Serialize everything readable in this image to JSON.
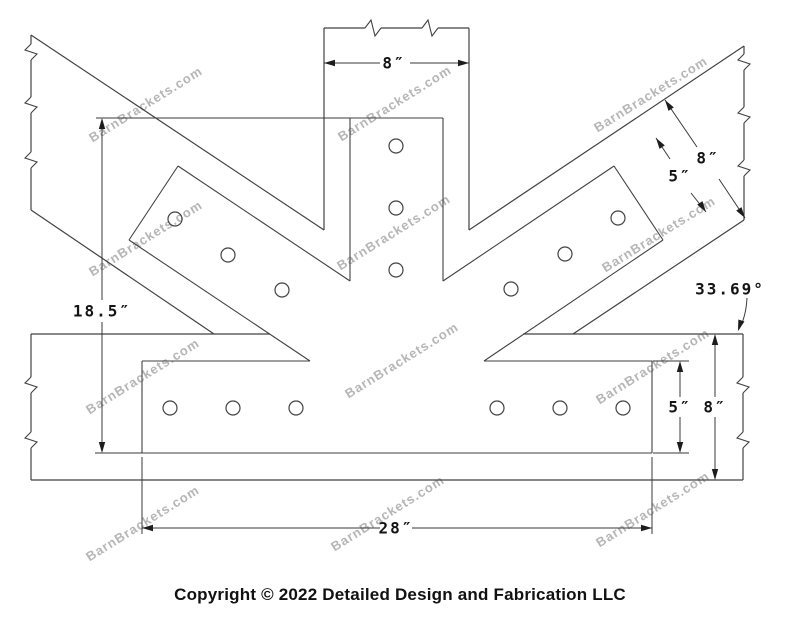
{
  "copyright": "Copyright © 2022 Detailed Design and Fabrication LLC",
  "watermark_text": "BarnBrackets.com",
  "canvas": {
    "width": 800,
    "height": 618,
    "background": "#ffffff"
  },
  "colors": {
    "geometry_line": "#424242",
    "dimension_line": "#3a3a3a",
    "dimension_text": "#141414",
    "watermark": "#b7b5b5"
  },
  "drawing": {
    "description": "Fan bracket shop drawing: vertical post, two 33.69-degree braces, horizontal beam, steel fan plate with bolt holes",
    "timber_segments": [
      [
        324,
        28,
        324,
        230
      ],
      [
        469,
        28,
        469,
        230
      ],
      [
        324,
        28,
        365,
        28
      ],
      [
        381,
        28,
        422,
        28
      ],
      [
        438,
        28,
        469,
        28
      ],
      [
        31,
        35,
        324,
        230
      ],
      [
        31,
        210,
        214,
        334
      ],
      [
        31,
        35,
        31,
        44
      ],
      [
        31,
        60,
        31,
        97
      ],
      [
        31,
        113,
        31,
        152
      ],
      [
        31,
        168,
        31,
        210
      ],
      [
        469,
        230,
        744,
        46
      ],
      [
        573,
        334,
        744,
        220
      ],
      [
        744,
        46,
        744,
        54
      ],
      [
        744,
        70,
        744,
        107
      ],
      [
        744,
        123,
        744,
        160
      ],
      [
        744,
        176,
        744,
        220
      ],
      [
        31,
        334,
        270,
        334
      ],
      [
        523,
        334,
        743,
        334
      ],
      [
        31,
        480,
        743,
        480
      ],
      [
        31,
        334,
        31,
        377
      ],
      [
        31,
        393,
        31,
        432
      ],
      [
        31,
        448,
        31,
        480
      ],
      [
        743,
        334,
        743,
        377
      ],
      [
        743,
        393,
        743,
        432
      ],
      [
        743,
        448,
        743,
        480
      ]
    ],
    "plate_segments": [
      [
        350,
        118,
        443,
        118
      ],
      [
        350,
        118,
        350,
        281
      ],
      [
        443,
        118,
        443,
        281
      ],
      [
        178,
        166,
        350,
        281
      ],
      [
        178,
        166,
        129,
        240
      ],
      [
        129,
        240,
        310,
        361
      ],
      [
        614,
        166,
        443,
        281
      ],
      [
        614,
        166,
        663,
        240
      ],
      [
        663,
        240,
        484,
        361
      ],
      [
        142,
        361,
        310,
        361
      ],
      [
        484,
        361,
        652,
        361
      ],
      [
        142,
        361,
        142,
        453
      ],
      [
        652,
        361,
        652,
        453
      ],
      [
        142,
        453,
        652,
        453
      ]
    ],
    "break_marks": [
      {
        "x": 373,
        "y": 28,
        "dir": "h"
      },
      {
        "x": 430,
        "y": 28,
        "dir": "h"
      },
      {
        "x": 31,
        "y": 52,
        "dir": "v"
      },
      {
        "x": 31,
        "y": 105,
        "dir": "v"
      },
      {
        "x": 31,
        "y": 160,
        "dir": "v"
      },
      {
        "x": 744,
        "y": 62,
        "dir": "v"
      },
      {
        "x": 744,
        "y": 115,
        "dir": "v"
      },
      {
        "x": 744,
        "y": 168,
        "dir": "v"
      },
      {
        "x": 31,
        "y": 385,
        "dir": "v"
      },
      {
        "x": 31,
        "y": 440,
        "dir": "v"
      },
      {
        "x": 743,
        "y": 385,
        "dir": "v"
      },
      {
        "x": 743,
        "y": 440,
        "dir": "v"
      }
    ],
    "hole_radius": 7,
    "holes": [
      [
        396,
        146
      ],
      [
        396,
        208
      ],
      [
        396,
        270
      ],
      [
        175,
        219
      ],
      [
        228,
        255
      ],
      [
        282,
        290
      ],
      [
        618,
        218
      ],
      [
        565,
        254
      ],
      [
        511,
        289
      ],
      [
        170,
        408
      ],
      [
        233,
        408
      ],
      [
        296,
        408
      ],
      [
        497,
        408
      ],
      [
        560,
        408
      ],
      [
        623,
        408
      ]
    ],
    "dimensions": [
      {
        "label": "8″",
        "label_x": 394,
        "label_y": 63,
        "segments": [
          [
            324,
            63,
            380,
            63
          ],
          [
            410,
            63,
            469,
            63
          ]
        ],
        "arrows": [
          [
            324,
            63,
            180
          ],
          [
            469,
            63,
            0
          ]
        ],
        "ext": []
      },
      {
        "label": "18.5″",
        "label_x": 102,
        "label_y": 311,
        "segments": [
          [
            102,
            122,
            102,
            300
          ],
          [
            102,
            322,
            102,
            449
          ]
        ],
        "arrows": [
          [
            102,
            118,
            270
          ],
          [
            102,
            453,
            90
          ]
        ],
        "ext": [
          [
            96,
            118,
            350,
            118
          ],
          [
            95,
            453,
            142,
            453
          ]
        ]
      },
      {
        "label": "8″",
        "label_x": 708,
        "label_y": 158,
        "segments": [
          [
            665,
            100,
            697,
            147
          ],
          [
            719,
            179,
            745,
            218
          ]
        ],
        "arrows": [
          [
            665,
            100,
            236
          ],
          [
            745,
            218,
            56
          ]
        ],
        "ext": []
      },
      {
        "label": "5″",
        "label_x": 680,
        "label_y": 176,
        "segments": [
          [
            656,
            138,
            670,
            159
          ],
          [
            691,
            193,
            706,
            212
          ]
        ],
        "arrows": [
          [
            656,
            138,
            236
          ],
          [
            706,
            212,
            56
          ]
        ],
        "ext": []
      },
      {
        "label": "5″",
        "label_x": 680,
        "label_y": 407,
        "segments": [
          [
            680,
            365,
            680,
            397
          ],
          [
            680,
            417,
            680,
            449
          ]
        ],
        "arrows": [
          [
            680,
            361,
            270
          ],
          [
            680,
            453,
            90
          ]
        ],
        "ext": [
          [
            653,
            361,
            689,
            361
          ],
          [
            653,
            453,
            689,
            453
          ]
        ]
      },
      {
        "label": "8″",
        "label_x": 715,
        "label_y": 407,
        "segments": [
          [
            715,
            338,
            715,
            397
          ],
          [
            715,
            417,
            715,
            476
          ]
        ],
        "arrows": [
          [
            715,
            334,
            270
          ],
          [
            715,
            480,
            90
          ]
        ],
        "ext": []
      },
      {
        "label": "28″",
        "label_x": 396,
        "label_y": 528,
        "segments": [
          [
            142,
            528,
            380,
            528
          ],
          [
            412,
            528,
            652,
            528
          ]
        ],
        "arrows": [
          [
            142,
            528,
            180
          ],
          [
            652,
            528,
            0
          ]
        ],
        "ext": [
          [
            142,
            457,
            142,
            534
          ],
          [
            652,
            457,
            652,
            534
          ]
        ]
      }
    ],
    "angle_dimension": {
      "label": "33.69°",
      "label_x": 730,
      "label_y": 289,
      "arc_path": "M 747 298 Q 746 317 739 329",
      "arrow": [
        738,
        331,
        108
      ]
    },
    "watermarks": [
      [
        148,
        108
      ],
      [
        397,
        107
      ],
      [
        653,
        98
      ],
      [
        148,
        242
      ],
      [
        396,
        236
      ],
      [
        661,
        238
      ],
      [
        145,
        380
      ],
      [
        404,
        364
      ],
      [
        655,
        370
      ],
      [
        145,
        527
      ],
      [
        390,
        517
      ],
      [
        655,
        513
      ]
    ],
    "watermark_rotation": -32
  }
}
